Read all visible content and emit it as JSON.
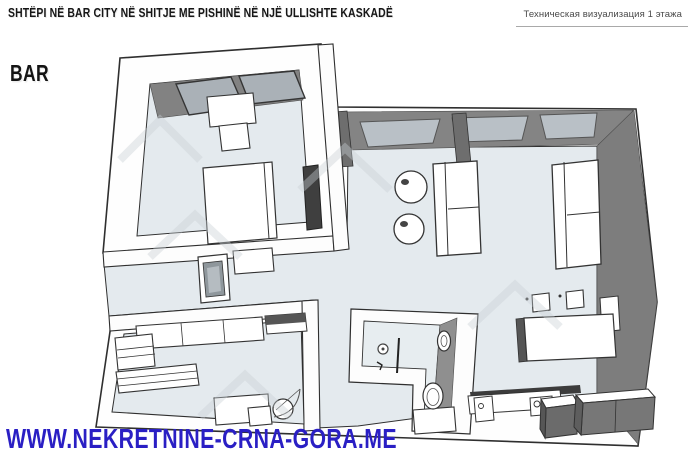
{
  "page": {
    "title": "SHTËPI NË BAR CITY NË SHITJE ME PISHINË NË NJË ULLISHTE KASKADË",
    "city_label": "BAR",
    "technical_annotation": "Техническая визуализация 1 этажа",
    "website": "WWW.NEKRETNINE-CRNA-GORA.ME"
  },
  "colors": {
    "title_black": "#161616",
    "annotation_gray": "#4a4a4a",
    "website_blue": "#2a1fc4",
    "wall_shadow_gray": "#7d7d7d",
    "floor_gray_blue": "#e4eaee",
    "window_glass": "#b9c0c6",
    "outline_dark": "#2f2f2f",
    "watermark_gray": "#c9d0d5"
  },
  "floorplan": {
    "view": "3d-top-down-visualization",
    "floor_label": "1",
    "rooms": [
      {
        "id": "bedroom-top-left",
        "furniture": [
          "window-panels",
          "desk",
          "chair",
          "double-bed",
          "wall-mirror"
        ]
      },
      {
        "id": "living-room",
        "furniture": [
          "window-wall",
          "pillars",
          "sofa-right",
          "sofa-center",
          "pouf",
          "pouf",
          "wall-console"
        ]
      },
      {
        "id": "dining-area",
        "furniture": [
          "dining-table",
          "chair",
          "chair"
        ]
      },
      {
        "id": "kitchen",
        "furniture": [
          "counter",
          "sink-unit",
          "cooktop",
          "island-unit",
          "appliance-unit"
        ]
      },
      {
        "id": "bathroom",
        "furniture": [
          "shower",
          "shower-glass",
          "washbasin",
          "toilet"
        ]
      },
      {
        "id": "bedroom-bottom-left",
        "furniture": [
          "wardrobe-row",
          "shelving-unit",
          "bed-shelves",
          "desk",
          "drawer-unit",
          "chair",
          "door-arc"
        ]
      },
      {
        "id": "hallway",
        "furniture": [
          "framed-picture",
          "wall-cabinet"
        ]
      }
    ]
  }
}
